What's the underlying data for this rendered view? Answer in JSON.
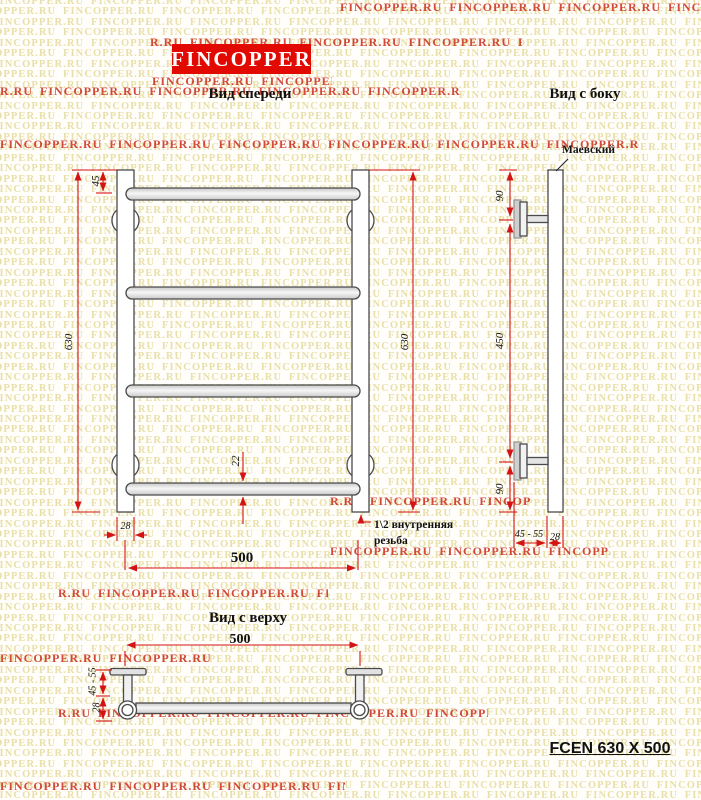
{
  "watermark": {
    "text": "FINCOPPER.RU",
    "tan_color": "#e8dfa9",
    "red_color": "#cb2a1a",
    "red_rows": [
      {
        "x": 340,
        "y": 0,
        "w": 361
      },
      {
        "x": 150,
        "y": 35,
        "w": 372
      },
      {
        "x": 152,
        "y": 74,
        "w": 180
      },
      {
        "x": 0,
        "y": 84,
        "w": 460
      },
      {
        "x": 0,
        "y": 137,
        "w": 640
      },
      {
        "x": 330,
        "y": 494,
        "w": 200
      },
      {
        "x": 330,
        "y": 544,
        "w": 280
      },
      {
        "x": 58,
        "y": 586,
        "w": 270
      },
      {
        "x": 0,
        "y": 651,
        "w": 210
      },
      {
        "x": 58,
        "y": 706,
        "w": 430
      },
      {
        "x": 0,
        "y": 779,
        "w": 345
      }
    ]
  },
  "logo": {
    "label": "FINCOPPER",
    "bg": "#e20a00"
  },
  "views": {
    "front": {
      "title": "Вид спереди",
      "dim_45": "45",
      "dim_630_left": "630",
      "dim_630_right": "630",
      "dim_22": "22",
      "dim_28": "28",
      "dim_500": "500",
      "thread_line1": "1\\2 внутренняя",
      "thread_line2": "резьба"
    },
    "side": {
      "title": "Вид с боку",
      "valve_label": "Маевский",
      "dim_90_top": "90",
      "dim_450": "450",
      "dim_90_bottom": "90",
      "dim_45_55": "45 - 55",
      "dim_28": "28"
    },
    "top": {
      "title": "Вид с верху",
      "dim_500": "500",
      "dim_45_55": "45 - 55",
      "dim_28": "28"
    }
  },
  "model_label": "FCEN 630 X 500",
  "colors": {
    "dimension": "#d41414",
    "line": "#4a4a4a"
  }
}
